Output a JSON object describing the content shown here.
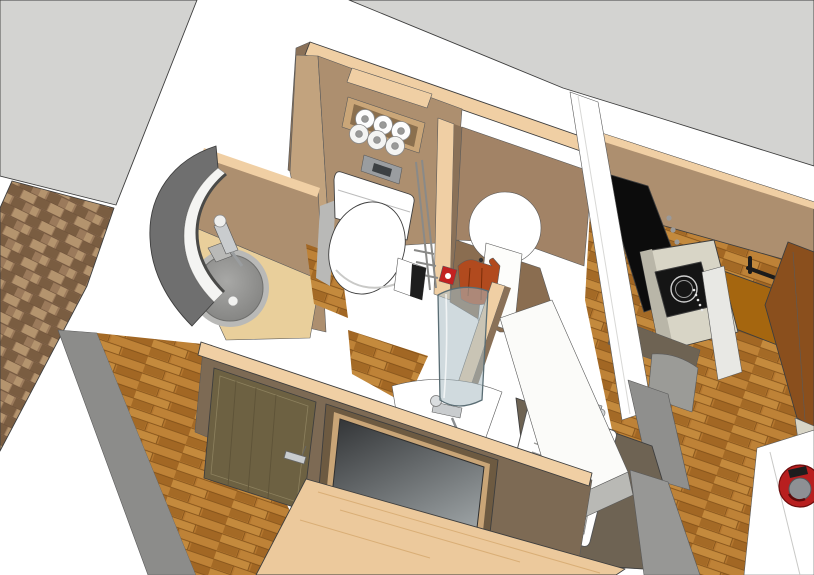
{
  "meta": {
    "title": "3D interior rendering - tiny-house bathroom and kitchenette module",
    "view": "bird's-eye axonometric",
    "style": "SketchUp-like model render, no visible text"
  },
  "colors": {
    "background": "#ffffff",
    "outline": "#3e3e3e",
    "roof_gray": "#d3d3d1",
    "brick_base": "#9b7a5b",
    "brick_dark": "#7a5d41",
    "brick_light": "#b4946e",
    "brick_joint": "#6e523a",
    "floor_base": "#b5772f",
    "floor_dark": "#9a611f",
    "floor_light": "#c78d3f",
    "floor_seam": "#7e4f18",
    "ply_edge": "#f0cfa4",
    "wall_tan": "#ad8f6f",
    "wall_tan_dark": "#8a7158",
    "wall_tan_light": "#c2a37e",
    "wall_front": "#7d6a54",
    "counter_wood": "#e9cf9b",
    "niche_frame": "#caa678",
    "niche_inner": "#8a6f4e",
    "door_olive": "#6d6142",
    "frame_brown": "#6d5a41",
    "frame_bevel": "#c9a577",
    "plank_light": "#ecc99c",
    "glass_blue": "#a9bcc2",
    "jacket_red": "#b14a1e",
    "hook_red": "#c32121",
    "appliance_black": "#0c0c0c",
    "cooktop_black": "#151515",
    "counter_beige": "#d8d5c6",
    "counter_sink_dark": "#6e6353",
    "cabinet_orange": "#a5660f",
    "cabinet_dark": "#8a4f1d",
    "steel": "#c9ccce",
    "white": "#ffffff",
    "slab_white": "#fbfbf9",
    "slab_edge": "#b9b9b5",
    "gray_mid": "#8c8c8a",
    "basin_rim": "#b9b9b7",
    "plate_gray": "#9a9da0",
    "plate_slot": "#3c4043",
    "extinguisher_red": "#b81f1f",
    "panel_dark": "#303234",
    "panel_light": "#9aa0a2",
    "curve_gray": "#6f6f6f"
  },
  "objects": {
    "viewport": "3D model viewport",
    "roof_panel_left": "gray wall/roof panel (upper left)",
    "roof_panel_right": "gray wall/roof panel (upper right)",
    "brick_wall": "brick-clad exterior wall strip",
    "wood_floor": "wood plank flooring",
    "bathroom": "bathroom module with plywood-edged walls",
    "toilet": "white toilet with closed lid",
    "toilet_paper_niche": "wall niche holding 6 toilet paper rolls",
    "flush_plate": "gray flush plate",
    "washbasin": "round gray washbasin with chrome faucet on wood counter",
    "curved_wall": "curved gray pocket wall with white stripe",
    "shower": "shower with curved glass screen, white tray and faucet",
    "jacket": "rust-red jacket hanging on wall hook",
    "entry_door": "olive wooden door with lever handle",
    "window_panel": "wood-framed dark window/mirror panel",
    "leaning_plank": "light wooden plank leaning against front wall",
    "kitchen": "kitchenette along right side",
    "kitchen_counter": "long white counter panel",
    "kitchen_sink": "white sink with ribbed drainboard",
    "cooktop": "black induction cooktop on pale counter",
    "black_appliance": "built-in black appliance bay",
    "orange_cabinet": "orange-brown cabinet with black towel bar",
    "dark_cabinet": "tall dark-wood cabinet at right edge",
    "side_table": "white table with red fire extinguisher (bottom right)"
  }
}
